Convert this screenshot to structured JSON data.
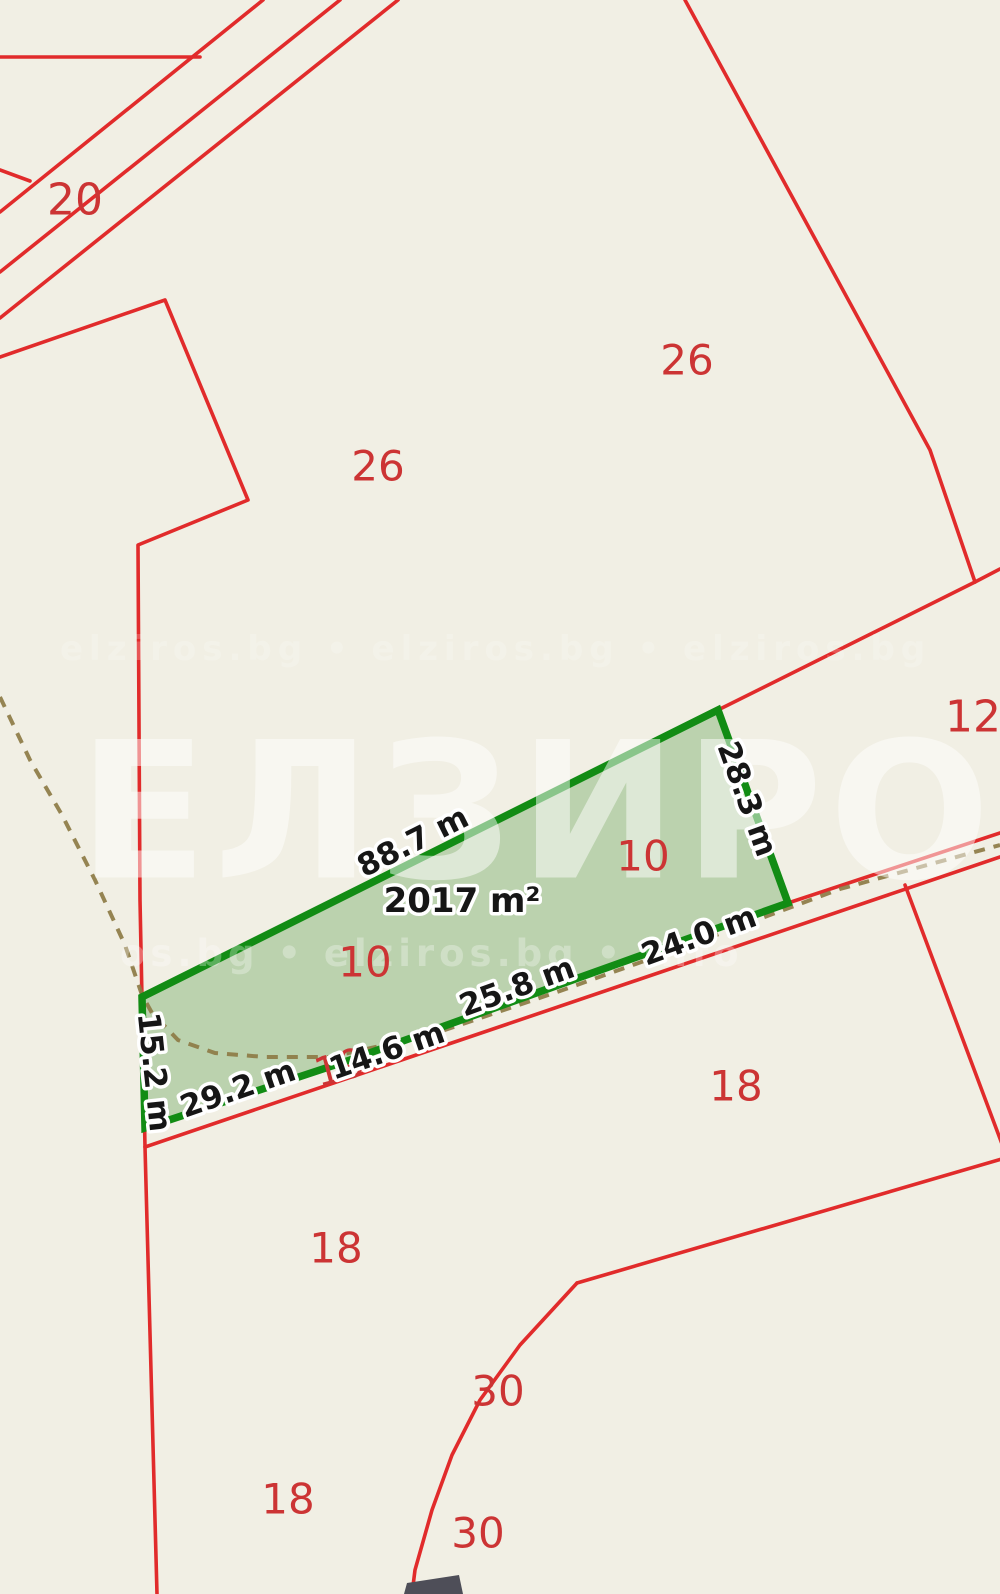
{
  "map": {
    "background_color": "#f1efe4",
    "boundary_color": "#e12b2b",
    "parcel_label_color": "#cc3434",
    "highlight_stroke_color": "#128c14",
    "highlight_fill_color": "rgba(122,175,108,0.45)",
    "path_color": "#8d7b45",
    "measurement_text_color": "#161616",
    "measurement_halo_color": "#ffffff",
    "building_color": "#4e4e58",
    "watermark_color": "#ffffff",
    "highlighted_parcel": {
      "number": "10",
      "area_label": "2017 m²",
      "area_label_pos": {
        "x": 462,
        "y": 901
      },
      "polygon": [
        [
          142,
          997
        ],
        [
          718,
          710
        ],
        [
          788,
          903
        ],
        [
          620,
          963
        ],
        [
          475,
          1015
        ],
        [
          350,
          1060
        ],
        [
          145,
          1128
        ]
      ],
      "measurements": [
        {
          "label": "88.7 m",
          "x": 413,
          "y": 842,
          "rotate": -26.5
        },
        {
          "label": "28.3 m",
          "x": 747,
          "y": 799,
          "rotate": 70
        },
        {
          "label": "24.0 m",
          "x": 699,
          "y": 936,
          "rotate": -20
        },
        {
          "label": "25.8 m",
          "x": 517,
          "y": 987,
          "rotate": -20
        },
        {
          "label": "14.6 m",
          "x": 387,
          "y": 1051,
          "rotate": -19
        },
        {
          "label": "29.2 m",
          "x": 238,
          "y": 1089,
          "rotate": -19
        },
        {
          "label": "15.2 m",
          "x": 154,
          "y": 1072,
          "rotate": 84
        }
      ]
    },
    "boundaries": [
      {
        "name": "road-topleft-line-a",
        "points": [
          [
            263,
            0
          ],
          [
            0,
            212
          ]
        ]
      },
      {
        "name": "road-topleft-line-b",
        "points": [
          [
            340,
            0
          ],
          [
            0,
            272
          ]
        ]
      },
      {
        "name": "road-topleft-line-c",
        "points": [
          [
            398,
            0
          ],
          [
            0,
            318
          ]
        ]
      },
      {
        "name": "road-topleft-spur",
        "points": [
          [
            0,
            57
          ],
          [
            200,
            57
          ]
        ]
      },
      {
        "name": "edge-fragment-left",
        "points": [
          [
            0,
            170
          ],
          [
            30,
            181
          ]
        ]
      },
      {
        "name": "parcel-26-west-boundary",
        "points": [
          [
            0,
            357
          ],
          [
            165,
            300
          ],
          [
            248,
            500
          ],
          [
            138,
            545
          ],
          [
            140,
            900
          ],
          [
            145,
            1147
          ],
          [
            157,
            1594
          ]
        ]
      },
      {
        "name": "boundary-26-12-diagonal",
        "points": [
          [
            685,
            0
          ],
          [
            930,
            450
          ],
          [
            975,
            582
          ]
        ]
      },
      {
        "name": "boundary-spur-right",
        "points": [
          [
            975,
            582
          ],
          [
            1000,
            569
          ]
        ]
      },
      {
        "name": "boundary-12-to-parcel10",
        "points": [
          [
            975,
            582
          ],
          [
            718,
            710
          ]
        ]
      },
      {
        "name": "road-right-upper-line",
        "points": [
          [
            1000,
            833
          ],
          [
            788,
            903
          ]
        ]
      },
      {
        "name": "road-right-lower-line",
        "points": [
          [
            1000,
            857
          ],
          [
            145,
            1147
          ]
        ]
      },
      {
        "name": "boundary-12-18-branch",
        "points": [
          [
            905,
            885
          ],
          [
            1005,
            1152
          ]
        ]
      },
      {
        "name": "boundary-18-30-upper",
        "points": [
          [
            1005,
            1158
          ],
          [
            577,
            1283
          ]
        ]
      },
      {
        "name": "boundary-18-30-curve",
        "points": [
          [
            577,
            1283
          ],
          [
            520,
            1345
          ],
          [
            480,
            1400
          ],
          [
            452,
            1455
          ],
          [
            432,
            1510
          ],
          [
            415,
            1570
          ],
          [
            412,
            1594
          ]
        ]
      }
    ],
    "dashed_path": {
      "name": "field-track-dashed-path",
      "points": [
        [
          0,
          697
        ],
        [
          30,
          760
        ],
        [
          62,
          815
        ],
        [
          95,
          880
        ],
        [
          125,
          945
        ],
        [
          142,
          995
        ],
        [
          152,
          1013
        ],
        [
          178,
          1040
        ],
        [
          215,
          1053
        ],
        [
          265,
          1057
        ],
        [
          330,
          1057
        ],
        [
          430,
          1035
        ],
        [
          560,
          991
        ],
        [
          700,
          941
        ],
        [
          840,
          889
        ],
        [
          1000,
          845
        ]
      ]
    },
    "building": {
      "points": [
        [
          407,
          1583
        ],
        [
          459,
          1575
        ],
        [
          463,
          1594
        ],
        [
          404,
          1594
        ]
      ]
    },
    "parcel_labels": [
      {
        "text": "20",
        "x": 75,
        "y": 200,
        "size": 44,
        "rotate": 0
      },
      {
        "text": "0",
        "x": -16,
        "y": 222,
        "size": 44,
        "rotate": 0
      },
      {
        "text": "26",
        "x": 378,
        "y": 466,
        "size": 42,
        "rotate": 0
      },
      {
        "text": "26",
        "x": 687,
        "y": 360,
        "size": 42,
        "rotate": 0
      },
      {
        "text": "12",
        "x": 973,
        "y": 717,
        "size": 44,
        "rotate": 0
      },
      {
        "text": "10",
        "x": 643,
        "y": 856,
        "size": 42,
        "rotate": 0
      },
      {
        "text": "10",
        "x": 365,
        "y": 962,
        "size": 42,
        "rotate": 0
      },
      {
        "text": "19",
        "x": 340,
        "y": 1068,
        "size": 40,
        "rotate": -15
      },
      {
        "text": "18",
        "x": 736,
        "y": 1086,
        "size": 42,
        "rotate": 0
      },
      {
        "text": "18",
        "x": 336,
        "y": 1248,
        "size": 42,
        "rotate": 0
      },
      {
        "text": "18",
        "x": 288,
        "y": 1499,
        "size": 42,
        "rotate": 0
      },
      {
        "text": "30",
        "x": 498,
        "y": 1391,
        "size": 42,
        "rotate": 0
      },
      {
        "text": "30",
        "x": 478,
        "y": 1533,
        "size": 42,
        "rotate": 0
      }
    ],
    "watermark": {
      "title": "ЕЛЗИРОС",
      "title_pos": {
        "x": 78,
        "y": 812,
        "size": 190,
        "opacity": 0.5,
        "spacing": 6
      },
      "rows": [
        {
          "text": "elziros.bg • elziros.bg • elziros.bg",
          "x": 60,
          "y": 660,
          "size": 34,
          "opacity": 0.2,
          "spacing": 6
        },
        {
          "text": "os.bg • elziros.bg • info",
          "x": 120,
          "y": 966,
          "size": 37,
          "opacity": 0.3,
          "spacing": 5
        }
      ]
    }
  }
}
